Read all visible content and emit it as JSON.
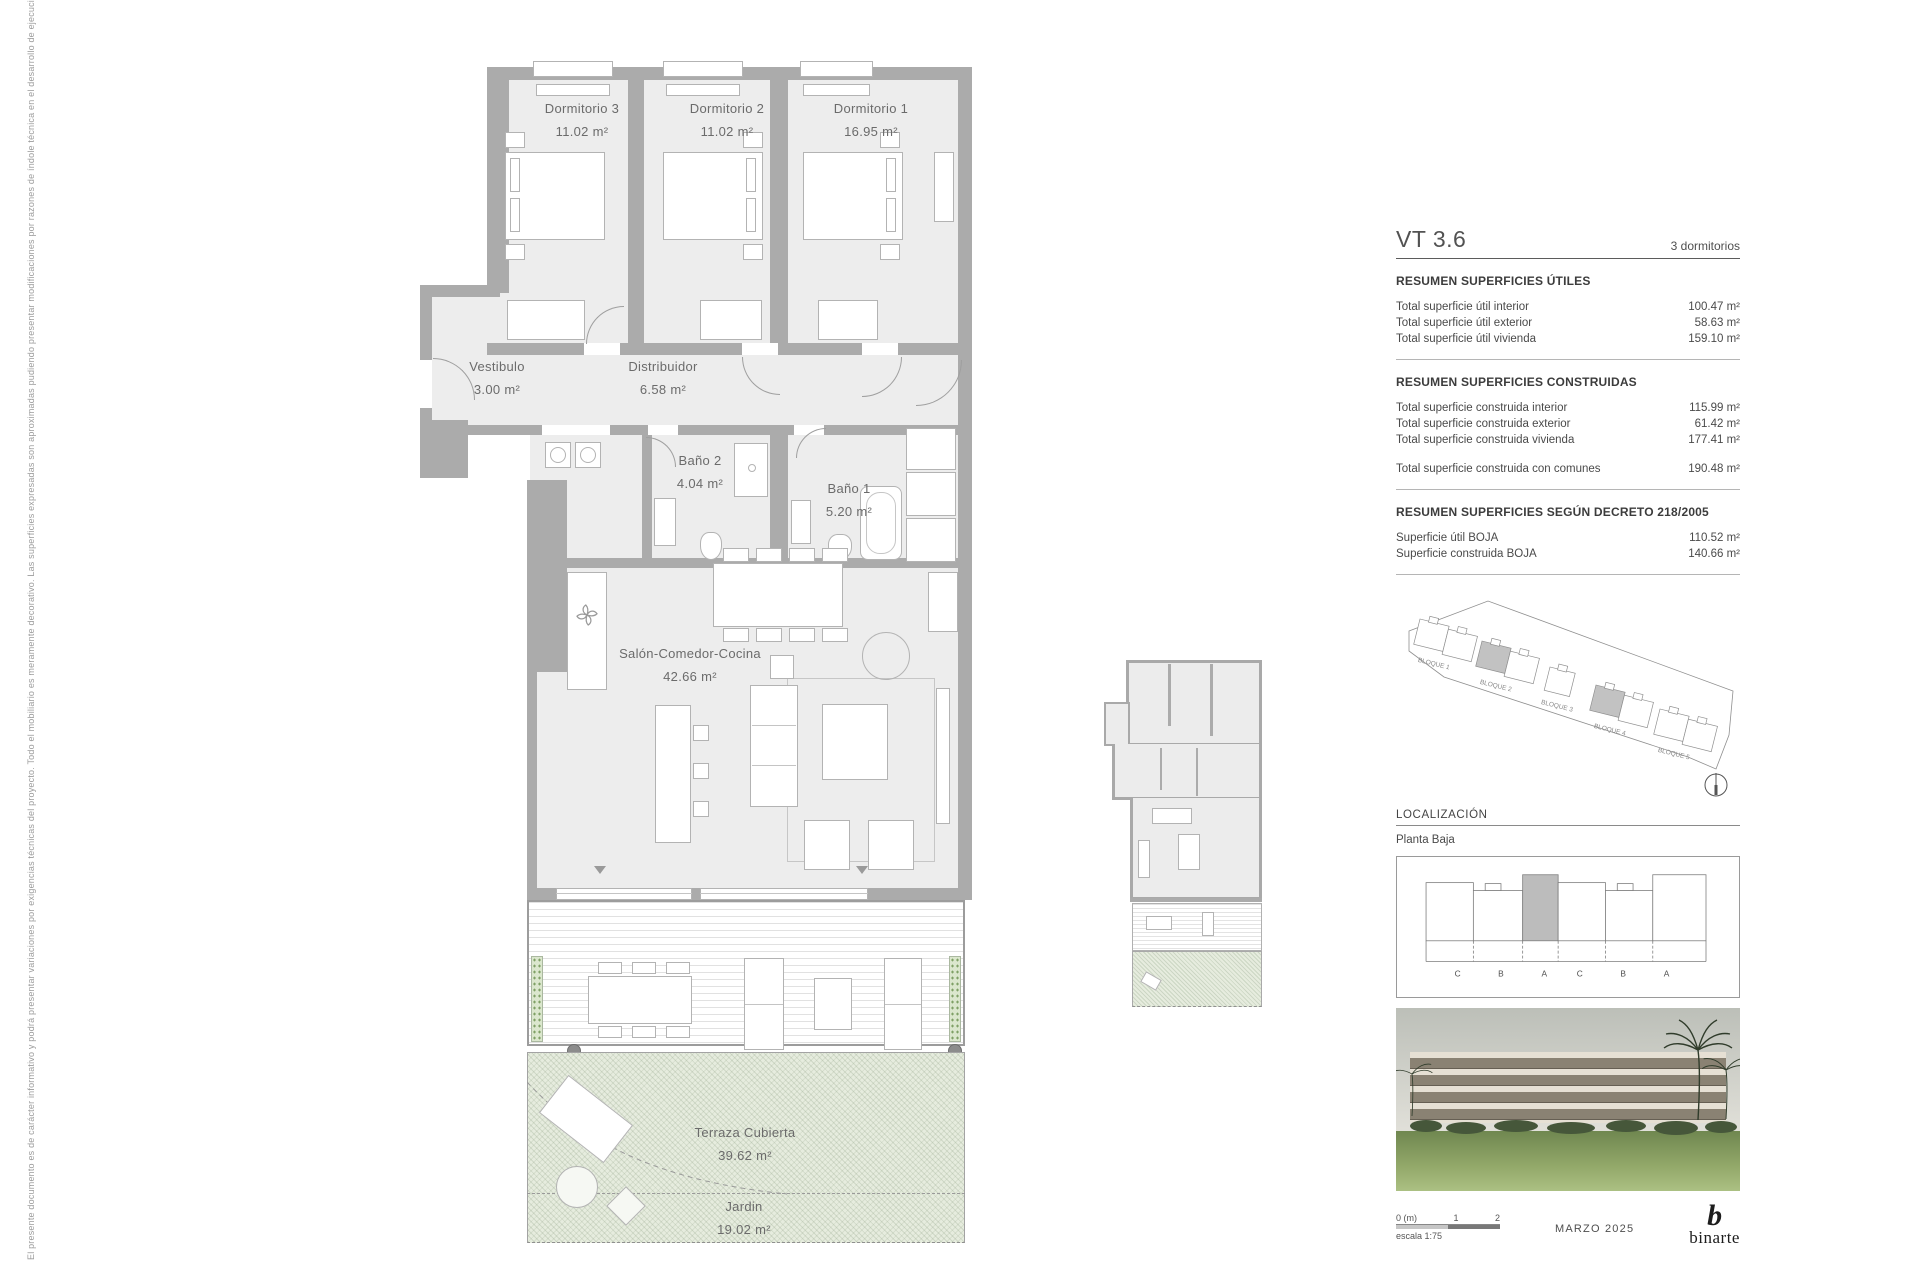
{
  "document": {
    "disclaimer": "El presente documento es de carácter informativo y podrá presentar variaciones por exigencias técnicas del proyecto. Todo el mobiliario es meramente decorativo. Las superficies expresadas son aproximadas pudiendo presentar modificaciones por razones de índole técnica en el desarrollo de ejecución de la obra."
  },
  "floor_plan": {
    "rooms": [
      {
        "name": "Dormitorio 3",
        "area": "11.02 m²"
      },
      {
        "name": "Dormitorio 2",
        "area": "11.02 m²"
      },
      {
        "name": "Dormitorio 1",
        "area": "16.95 m²"
      },
      {
        "name": "Vestibulo",
        "area": "3.00 m²"
      },
      {
        "name": "Distribuidor",
        "area": "6.58 m²"
      },
      {
        "name": "Baño 2",
        "area": "4.04 m²"
      },
      {
        "name": "Baño 1",
        "area": "5.20 m²"
      },
      {
        "name": "Salón-Comedor-Cocina",
        "area": "42.66 m²"
      },
      {
        "name": "Terraza Cubierta",
        "area": "39.62 m²"
      },
      {
        "name": "Jardin",
        "area": "19.02 m²"
      }
    ]
  },
  "panel": {
    "unit_code": "VT 3.6",
    "unit_type": "3 dormitorios",
    "utiles": {
      "title": "RESUMEN SUPERFICIES ÚTILES",
      "rows": [
        {
          "label": "Total superficie útil interior",
          "value": "100.47 m²"
        },
        {
          "label": "Total superficie útil exterior",
          "value": "58.63 m²"
        },
        {
          "label": "Total superficie útil vivienda",
          "value": "159.10 m²"
        }
      ]
    },
    "construidas": {
      "title": "RESUMEN SUPERFICIES CONSTRUIDAS",
      "rows": [
        {
          "label": "Total superficie construida interior",
          "value": "115.99 m²"
        },
        {
          "label": "Total superficie construida exterior",
          "value": "61.42 m²"
        },
        {
          "label": "Total superficie construida vivienda",
          "value": "177.41 m²"
        }
      ],
      "total_row": {
        "label": "Total superficie construida con comunes",
        "value": "190.48 m²"
      }
    },
    "decreto": {
      "title": "RESUMEN SUPERFICIES SEGÚN DECRETO 218/2005",
      "rows": [
        {
          "label": "Superficie útil BOJA",
          "value": "110.52 m²"
        },
        {
          "label": "Superficie construida BOJA",
          "value": "140.66 m²"
        }
      ]
    },
    "site_plan": {
      "blocks": [
        "BLOQUE 1",
        "BLOQUE 2",
        "BLOQUE 3",
        "BLOQUE 4",
        "BLOQUE 5"
      ]
    },
    "localizacion": {
      "title": "LOCALIZACIÓN",
      "floor": "Planta Baja",
      "letters": [
        "C",
        "B",
        "A",
        "C",
        "B",
        "A"
      ]
    },
    "footer": {
      "scale_zero": "0 (m)",
      "scale_one": "1",
      "scale_two": "2",
      "scale_text": "escala 1:75",
      "date": "MARZO 2025",
      "logo_mark": "b",
      "logo_word": "binarte"
    }
  }
}
